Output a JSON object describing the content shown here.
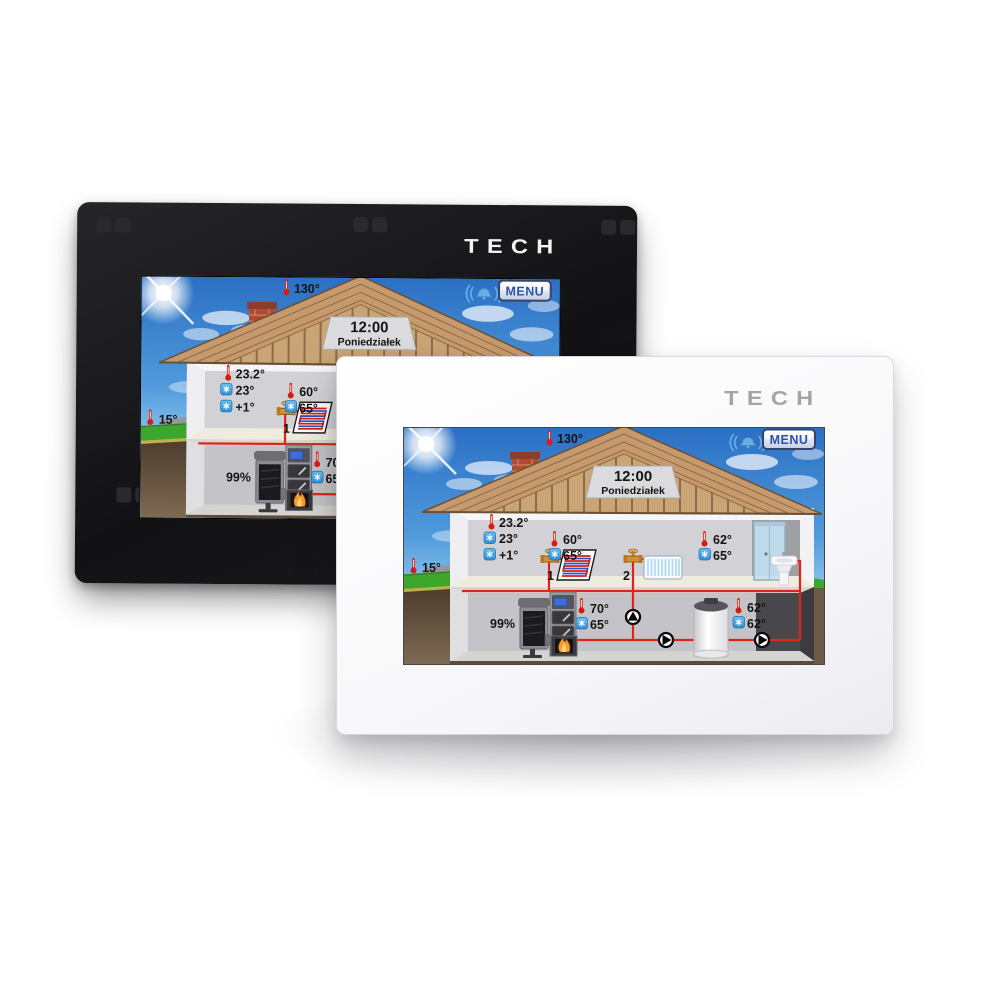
{
  "brand": {
    "logo": "TECH"
  },
  "devices": {
    "black": {
      "label": "black wall controller",
      "logo": "TECH"
    },
    "white": {
      "label": "white wall controller",
      "logo": "TECH"
    }
  },
  "screen": {
    "menu_label": "MENU",
    "header": {
      "time": "12:00",
      "day": "Poniedziałek"
    },
    "flue_temp": "130°",
    "outside_temp": "15°",
    "room": {
      "current_temp": "23.2°",
      "set_temp": "23°",
      "correction": "+1°"
    },
    "circuit_1": {
      "number": "1",
      "current_temp": "60°",
      "set_temp": "65°"
    },
    "circuit_2": {
      "number": "2",
      "current_temp": "62°",
      "set_temp": "65°"
    },
    "boiler": {
      "fuel_level": "99%",
      "current_temp": "70°",
      "set_temp": "65°"
    },
    "hot_water_tank": {
      "current_temp": "62°",
      "set_temp": "62°"
    },
    "icons": {
      "current_temp": "thermometer-icon",
      "set_temp": "snowflake-icon",
      "alarm": "bell-icon",
      "pump": "pump-arrow-icon",
      "valve": "valve-icon"
    }
  },
  "colors": {
    "bezel_black": "#141416",
    "bezel_white": "#fdfdfe",
    "logo_gray": "#a4a4a8",
    "menu_text_blue": "#2b50b4",
    "pipe_red": "#e02418",
    "setpoint_icon_blue": "#3f9fe0",
    "sky_blue": "#2b6fc4",
    "roof_tan": "#c69a6d",
    "grass_green": "#3da62c"
  }
}
